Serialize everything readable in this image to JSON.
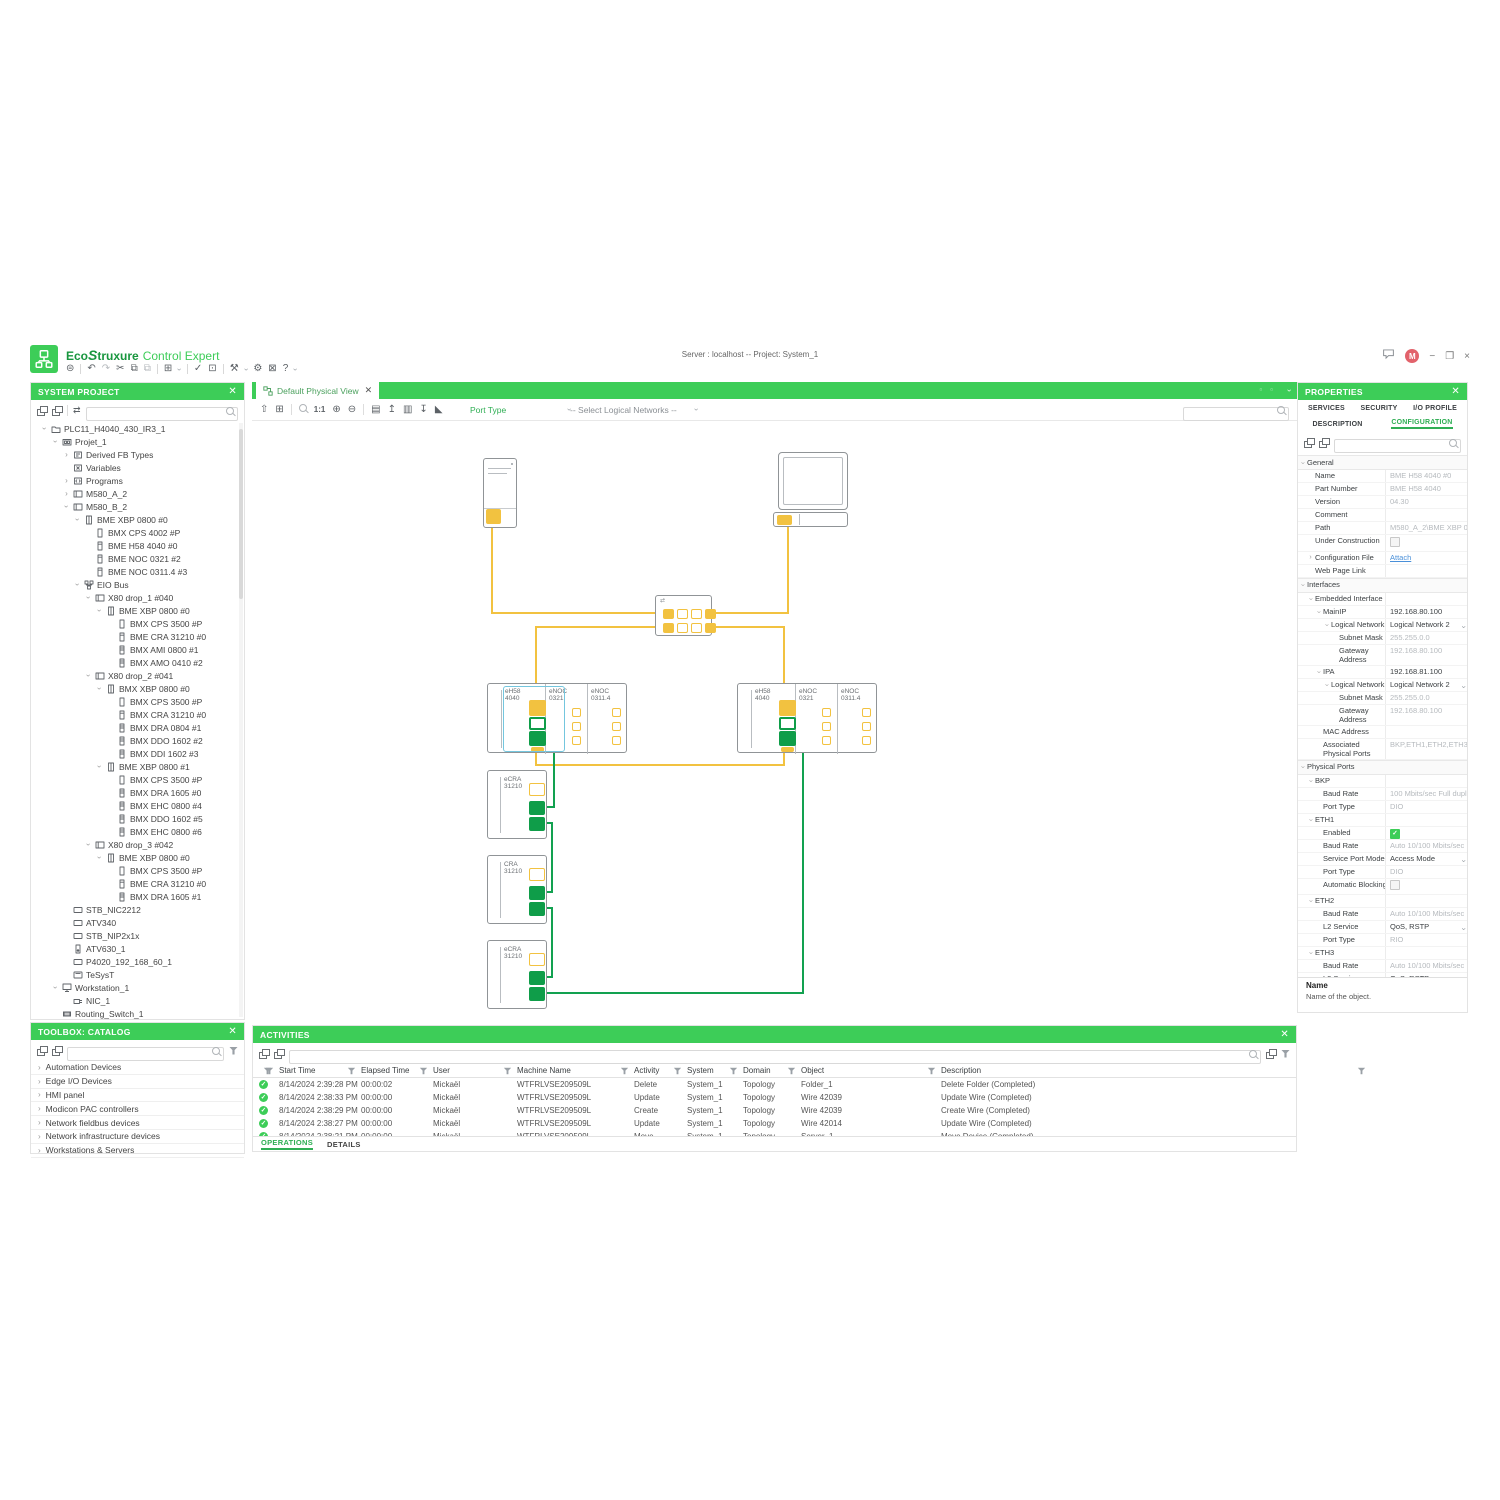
{
  "header": {
    "brand": {
      "eco": "Eco",
      "swirl": "S",
      "truxure": "truxure",
      "product": "Control Expert"
    },
    "center_title": "Server : localhost -- Project: System_1",
    "avatar_initial": "M"
  },
  "top_toolbar": {
    "items": [
      {
        "name": "session-icon",
        "glyph": "⊜"
      },
      {
        "name": "sep"
      },
      {
        "name": "undo-icon",
        "glyph": "↶"
      },
      {
        "name": "redo-icon",
        "glyph": "↷",
        "dim": true
      },
      {
        "name": "cut-icon",
        "glyph": "✂"
      },
      {
        "name": "copy-icon",
        "glyph": "⧉"
      },
      {
        "name": "paste-icon",
        "glyph": "⧉",
        "dim": true
      },
      {
        "name": "sep"
      },
      {
        "name": "window-layout-icon",
        "glyph": "⊞"
      },
      {
        "name": "caret"
      },
      {
        "name": "sep"
      },
      {
        "name": "validate-icon",
        "glyph": "✓"
      },
      {
        "name": "deploy-icon",
        "glyph": "⊡"
      },
      {
        "name": "sep"
      },
      {
        "name": "tools-icon",
        "glyph": "⚒"
      },
      {
        "name": "caret"
      },
      {
        "name": "settings-gear-icon",
        "glyph": "⚙"
      },
      {
        "name": "fit-screen-icon",
        "glyph": "⊠"
      },
      {
        "name": "help-icon",
        "glyph": "?"
      },
      {
        "name": "caret"
      }
    ]
  },
  "system_project": {
    "title": "SYSTEM PROJECT",
    "search_placeholder": "",
    "tree": [
      {
        "d": 0,
        "c": "open",
        "i": "folder",
        "l": "PLC11_H4040_430_IR3_1"
      },
      {
        "d": 1,
        "c": "open",
        "i": "station",
        "l": "Projet_1"
      },
      {
        "d": 2,
        "c": "closed",
        "i": "fb",
        "l": "Derived FB Types"
      },
      {
        "d": 2,
        "i": "variables",
        "l": "Variables"
      },
      {
        "d": 2,
        "c": "closed",
        "i": "programs",
        "l": "Programs"
      },
      {
        "d": 2,
        "c": "closed",
        "i": "rack",
        "l": "M580_A_2"
      },
      {
        "d": 2,
        "c": "open",
        "i": "rack",
        "l": "M580_B_2"
      },
      {
        "d": 3,
        "c": "open",
        "i": "backplane",
        "l": "BME XBP 0800 #0"
      },
      {
        "d": 4,
        "i": "psu",
        "l": "BMX CPS 4002 #P"
      },
      {
        "d": 4,
        "i": "cpu",
        "l": "BME H58 4040 #0"
      },
      {
        "d": 4,
        "i": "cpu",
        "l": "BME NOC 0321 #2"
      },
      {
        "d": 4,
        "i": "cpu",
        "l": "BME NOC 0311.4 #3"
      },
      {
        "d": 3,
        "c": "open",
        "i": "net",
        "l": "EIO Bus"
      },
      {
        "d": 4,
        "c": "open",
        "i": "rack",
        "l": "X80 drop_1 #040"
      },
      {
        "d": 5,
        "c": "open",
        "i": "backplane",
        "l": "BME XBP 0800 #0"
      },
      {
        "d": 6,
        "i": "psu",
        "l": "BMX CPS 3500 #P"
      },
      {
        "d": 6,
        "i": "cpu",
        "l": "BME CRA 31210 #0"
      },
      {
        "d": 6,
        "i": "module",
        "l": "BMX AMI 0800 #1"
      },
      {
        "d": 6,
        "i": "module",
        "l": "BMX AMO 0410 #2"
      },
      {
        "d": 4,
        "c": "open",
        "i": "rack",
        "l": "X80 drop_2 #041"
      },
      {
        "d": 5,
        "c": "open",
        "i": "backplane",
        "l": "BMX XBP 0800 #0"
      },
      {
        "d": 6,
        "i": "psu",
        "l": "BMX CPS 3500 #P"
      },
      {
        "d": 6,
        "i": "cpu",
        "l": "BMX CRA 31210 #0"
      },
      {
        "d": 6,
        "i": "module",
        "l": "BMX DRA 0804 #1"
      },
      {
        "d": 6,
        "i": "module",
        "l": "BMX DDO 1602 #2"
      },
      {
        "d": 6,
        "i": "module",
        "l": "BMX DDI 1602 #3"
      },
      {
        "d": 5,
        "c": "open",
        "i": "backplane",
        "l": "BME XBP 0800 #1"
      },
      {
        "d": 6,
        "i": "psu",
        "l": "BMX CPS 3500 #P"
      },
      {
        "d": 6,
        "i": "module",
        "l": "BMX DRA 1605 #0"
      },
      {
        "d": 6,
        "i": "module",
        "l": "BMX EHC 0800 #4"
      },
      {
        "d": 6,
        "i": "module",
        "l": "BMX DDO 1602 #5"
      },
      {
        "d": 6,
        "i": "module",
        "l": "BMX EHC 0800 #6"
      },
      {
        "d": 4,
        "c": "open",
        "i": "rack",
        "l": "X80 drop_3 #042"
      },
      {
        "d": 5,
        "c": "open",
        "i": "backplane",
        "l": "BME XBP 0800 #0"
      },
      {
        "d": 6,
        "i": "psu",
        "l": "BMX CPS 3500 #P"
      },
      {
        "d": 6,
        "i": "cpu",
        "l": "BME CRA 31210 #0"
      },
      {
        "d": 6,
        "i": "module",
        "l": "BMX DRA 1605 #1"
      },
      {
        "d": 2,
        "i": "device",
        "l": "STB_NIC2212"
      },
      {
        "d": 2,
        "i": "device",
        "l": "ATV340"
      },
      {
        "d": 2,
        "i": "device",
        "l": "STB_NIP2x1x"
      },
      {
        "d": 2,
        "i": "drive",
        "l": "ATV630_1"
      },
      {
        "d": 2,
        "i": "device",
        "l": "P4020_192_168_60_1"
      },
      {
        "d": 2,
        "i": "tesyst",
        "l": "TeSysT"
      },
      {
        "d": 1,
        "c": "open",
        "i": "workstation",
        "l": "Workstation_1"
      },
      {
        "d": 2,
        "i": "nic",
        "l": "NIC_1"
      },
      {
        "d": 1,
        "i": "switch",
        "l": "Routing_Switch_1"
      }
    ]
  },
  "toolbox": {
    "title": "TOOLBOX: CATALOG",
    "search_placeholder": "",
    "categories": [
      "Automation Devices",
      "Edge I/O Devices",
      "HMI panel",
      "Modicon PAC controllers",
      "Network fieldbus devices",
      "Network infrastructure devices",
      "Workstations & Servers"
    ]
  },
  "view_tab": {
    "label": "Default Physical View"
  },
  "canvas_toolbar": {
    "items": [
      {
        "name": "export-view-icon",
        "glyph": "⇧"
      },
      {
        "name": "grid-icon",
        "glyph": "⊞"
      },
      {
        "name": "sep"
      },
      {
        "name": "zoom-search-icon",
        "glyph": "mag"
      },
      {
        "name": "zoom-actual-label",
        "glyph": "1:1"
      },
      {
        "name": "zoom-in-icon",
        "glyph": "⊕"
      },
      {
        "name": "zoom-out-icon",
        "glyph": "⊖"
      },
      {
        "name": "sep"
      },
      {
        "name": "save-view-icon",
        "glyph": "▤"
      },
      {
        "name": "export-image-icon",
        "glyph": "↥"
      },
      {
        "name": "print-icon",
        "glyph": "▥"
      },
      {
        "name": "import-view-icon",
        "glyph": "↧"
      },
      {
        "name": "align-icon",
        "glyph": "◣"
      }
    ],
    "port_type_label": "Port Type",
    "networks_label": "-- Select Logical Networks --",
    "search_placeholder": ""
  },
  "diagram": {
    "rack_a": {
      "modules": [
        {
          "l1": "eH58",
          "l2": "4040"
        },
        {
          "l1": "eNOC",
          "l2": "0321"
        },
        {
          "l1": "eNOC",
          "l2": "0311.4"
        }
      ],
      "selected_module": 0
    },
    "rack_b": {
      "modules": [
        {
          "l1": "eH58",
          "l2": "4040"
        },
        {
          "l1": "eNOC",
          "l2": "0321"
        },
        {
          "l1": "eNOC",
          "l2": "0311.4"
        }
      ],
      "selected_module": null
    },
    "drops": [
      {
        "l1": "eCRA",
        "l2": "31210"
      },
      {
        "l1": "CRA",
        "l2": "31210"
      },
      {
        "l1": "eCRA",
        "l2": "31210"
      }
    ],
    "colors": {
      "wire_yellow": "#F2C240",
      "wire_green": "#12A150",
      "port_green": "#0F9D49",
      "selection": "#74C6DE",
      "device_border": "#909497"
    }
  },
  "properties": {
    "title": "PROPERTIES",
    "tabs_row1": [
      {
        "label": "SERVICES"
      },
      {
        "label": "SECURITY"
      },
      {
        "label": "I/O PROFILE"
      }
    ],
    "tabs_row2": [
      {
        "label": "DESCRIPTION"
      },
      {
        "label": "CONFIGURATION",
        "active": true
      }
    ],
    "search_placeholder": "",
    "rows": [
      {
        "t": "section",
        "c": "open",
        "l": "General"
      },
      {
        "i": 1,
        "l": "Name",
        "v": "BME H58 4040 #0",
        "s": "gray"
      },
      {
        "i": 1,
        "l": "Part Number",
        "v": "BME H58 4040",
        "s": "gray"
      },
      {
        "i": 1,
        "l": "Version",
        "v": "04.30",
        "s": "gray"
      },
      {
        "i": 1,
        "l": "Comment",
        "v": "",
        "s": "gray"
      },
      {
        "i": 1,
        "l": "Path",
        "v": "M580_A_2\\BME XBP 0800",
        "s": "gray"
      },
      {
        "i": 1,
        "l": "Under Construction",
        "x": "check-off"
      },
      {
        "i": 1,
        "c": "closed",
        "l": "Configuration File",
        "v": "Attach",
        "x": "link"
      },
      {
        "i": 1,
        "l": "Web Page Link",
        "v": "",
        "s": "gray"
      },
      {
        "t": "section",
        "c": "open",
        "l": "Interfaces"
      },
      {
        "i": 1,
        "c": "open",
        "l": "Embedded Interface"
      },
      {
        "i": 2,
        "c": "open",
        "l": "MainIP",
        "v": "192.168.80.100",
        "s": "dark"
      },
      {
        "i": 3,
        "c": "open",
        "l": "Logical Network",
        "v": "Logical Network 2",
        "s": "dark",
        "x": "dropdown"
      },
      {
        "i": 4,
        "l": "Subnet Mask",
        "v": "255.255.0.0",
        "s": "gray"
      },
      {
        "i": 4,
        "l": "Gateway Address",
        "v": "192.168.80.100",
        "s": "gray",
        "wrap": true
      },
      {
        "i": 2,
        "c": "open",
        "l": "IPA",
        "v": "192.168.81.100",
        "s": "dark"
      },
      {
        "i": 3,
        "c": "open",
        "l": "Logical Network",
        "v": "Logical Network 2",
        "s": "dark",
        "x": "dropdown"
      },
      {
        "i": 4,
        "l": "Subnet Mask",
        "v": "255.255.0.0",
        "s": "gray"
      },
      {
        "i": 4,
        "l": "Gateway Address",
        "v": "192.168.80.100",
        "s": "gray",
        "wrap": true
      },
      {
        "i": 2,
        "l": "MAC Address",
        "v": "",
        "s": "gray"
      },
      {
        "i": 2,
        "l": "Associated Physical Ports",
        "v": "BKP,ETH1,ETH2,ETH3",
        "s": "gray",
        "wrap": true
      },
      {
        "t": "section",
        "c": "open",
        "l": "Physical Ports"
      },
      {
        "i": 1,
        "c": "open",
        "l": "BKP"
      },
      {
        "i": 2,
        "l": "Baud Rate",
        "v": "100 Mbits/sec Full duplex",
        "s": "gray"
      },
      {
        "i": 2,
        "l": "Port Type",
        "v": "DIO",
        "s": "gray"
      },
      {
        "i": 1,
        "c": "open",
        "l": "ETH1"
      },
      {
        "i": 2,
        "l": "Enabled",
        "x": "check-on"
      },
      {
        "i": 2,
        "l": "Baud Rate",
        "v": "Auto 10/100 Mbits/sec",
        "s": "gray"
      },
      {
        "i": 2,
        "l": "Service Port Mode",
        "v": "Access Mode",
        "s": "dark",
        "x": "dropdown"
      },
      {
        "i": 2,
        "l": "Port Type",
        "v": "DIO",
        "s": "gray"
      },
      {
        "i": 2,
        "l": "Automatic Blocking",
        "x": "check-off"
      },
      {
        "i": 1,
        "c": "open",
        "l": "ETH2"
      },
      {
        "i": 2,
        "l": "Baud Rate",
        "v": "Auto 10/100 Mbits/sec",
        "s": "gray"
      },
      {
        "i": 2,
        "l": "L2 Service",
        "v": "QoS, RSTP",
        "s": "dark",
        "x": "dropdown"
      },
      {
        "i": 2,
        "l": "Port Type",
        "v": "RIO",
        "s": "gray"
      },
      {
        "i": 1,
        "c": "open",
        "l": "ETH3"
      },
      {
        "i": 2,
        "l": "Baud Rate",
        "v": "Auto 10/100 Mbits/sec",
        "s": "gray"
      },
      {
        "i": 2,
        "l": "L2 Service",
        "v": "QoS, RSTP",
        "s": "dark",
        "x": "dropdown"
      }
    ],
    "footer_title": "Name",
    "footer_desc": "Name of the object."
  },
  "activities": {
    "title": "ACTIVITIES",
    "search_placeholder": "",
    "columns": [
      "Start Time",
      "Elapsed Time",
      "User",
      "Machine Name",
      "Activity",
      "System",
      "Domain",
      "Object",
      "Description"
    ],
    "rows": [
      [
        "8/14/2024 2:39:28 PM",
        "00:00:02",
        "Mickaël",
        "WTFRLVSE209509L",
        "Delete",
        "System_1",
        "Topology",
        "Folder_1",
        "Delete Folder (Completed)"
      ],
      [
        "8/14/2024 2:38:33 PM",
        "00:00:00",
        "Mickaël",
        "WTFRLVSE209509L",
        "Update",
        "System_1",
        "Topology",
        "Wire 42039",
        "Update Wire (Completed)"
      ],
      [
        "8/14/2024 2:38:29 PM",
        "00:00:00",
        "Mickaël",
        "WTFRLVSE209509L",
        "Create",
        "System_1",
        "Topology",
        "Wire 42039",
        "Create Wire (Completed)"
      ],
      [
        "8/14/2024 2:38:27 PM",
        "00:00:00",
        "Mickaël",
        "WTFRLVSE209509L",
        "Update",
        "System_1",
        "Topology",
        "Wire 42014",
        "Update Wire (Completed)"
      ],
      [
        "8/14/2024 2:38:21 PM",
        "00:00:00",
        "Mickaël",
        "WTFRLVSE209509L",
        "Move",
        "System_1",
        "Topology",
        "Server_1",
        "Move Device (Completed)"
      ]
    ],
    "tabs": [
      {
        "label": "OPERATIONS",
        "active": true
      },
      {
        "label": "DETAILS"
      }
    ]
  }
}
